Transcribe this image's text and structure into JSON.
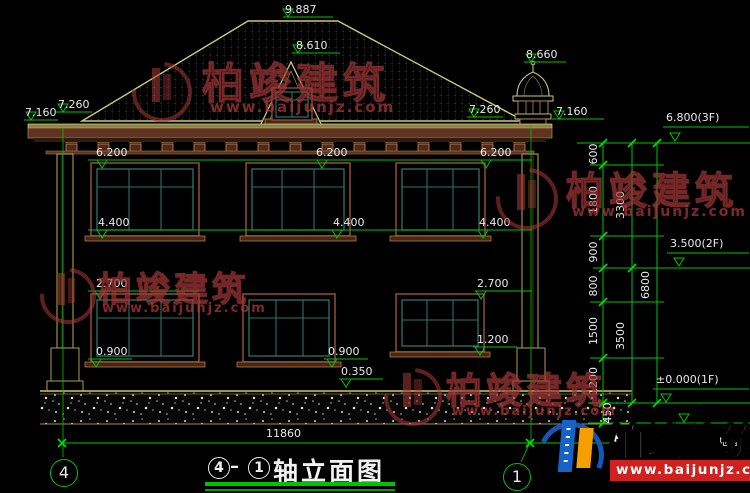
{
  "elevation_labels": {
    "ridge": "9.887",
    "dormer": "8.610",
    "chimney": "8.660",
    "eave_left_outer": "7.160",
    "eave_left_inner": "7.260",
    "eave_right_inner": "7.260",
    "eave_right_outer": "7.160",
    "floor2_window_head": [
      "6.200",
      "6.200",
      "6.200"
    ],
    "floor2_window_sill": [
      "4.400",
      "4.400",
      "4.400"
    ],
    "floor1_window_head_left": "2.700",
    "floor1_window_head_right": "2.700",
    "floor1_window_sill_left": "0.900",
    "floor1_window_sill_center": "0.900",
    "floor1_window_sill_right": "1.200",
    "plinth": "0.350"
  },
  "story_levels": {
    "roof": "6.800(3F)",
    "second": "3.500(2F)",
    "ground": "±0.000(1F)",
    "outdoor": "(室外地面)"
  },
  "dim_chain": {
    "segments": [
      "600",
      "1800",
      "900",
      "800",
      "1500",
      "1200",
      "450"
    ],
    "subtotals": [
      "3300",
      "3500"
    ],
    "total": "6800"
  },
  "bottom": {
    "overall_width": "11860",
    "axis_left": "4",
    "axis_right": "1"
  },
  "drawing_title": {
    "axis_start": "4",
    "separator": "–",
    "axis_end": "1",
    "name": "轴立面图"
  },
  "watermark": {
    "company": "柏竣建筑",
    "website": "www.baijunjz.com"
  },
  "logo": {
    "company": "柏竣建筑",
    "website": "www.baijunjz.com"
  }
}
